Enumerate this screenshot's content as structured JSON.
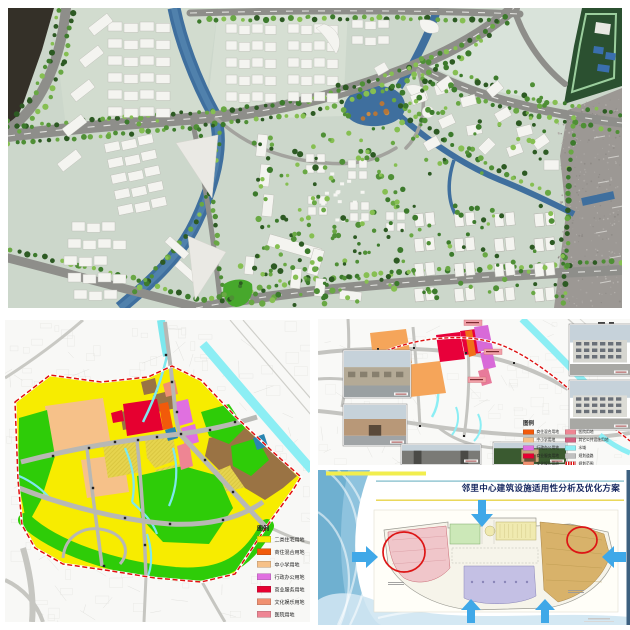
{
  "collage": {
    "background": "#ffffff",
    "panels": [
      "model-photo",
      "landuse-map",
      "facilities-map",
      "analysis-slide"
    ]
  },
  "model_photo": {
    "description": "aerial photo of physical urban-planning scale model",
    "colors": {
      "base_plate": "#ccd7cb",
      "river": "#3f6f9e",
      "road": "#8e8e8a",
      "building": "#f4f4f0",
      "tree_dark": "#2d5a23",
      "tree_light": "#86bf52",
      "gravel": "#9c9894",
      "side_model": "#2b5030"
    }
  },
  "left_map": {
    "legend_title": "图例",
    "legend_items": [
      {
        "label": "二类住宅用地",
        "color": "#f7ec00"
      },
      {
        "label": "商住混合用地",
        "color": "#f25a0a"
      },
      {
        "label": "中小学用地",
        "color": "#f6c189"
      },
      {
        "label": "行政办公用地",
        "color": "#e070e0"
      },
      {
        "label": "商业服务用地",
        "color": "#e60030"
      },
      {
        "label": "文化娱乐用地",
        "color": "#f09070"
      },
      {
        "label": "医院用地",
        "color": "#ee8593"
      },
      {
        "label": "其它公共设施",
        "color": "#d26080"
      }
    ],
    "colors": {
      "water": "#7de8ee",
      "road": "#b8b8b4",
      "boundary": "#e01010",
      "green_space": "#2ecc08",
      "village": "#9a7344"
    }
  },
  "right_map": {
    "legend_title": "图例",
    "legend_left": [
      {
        "label": "商住混合用地",
        "color": "#f25a0a"
      },
      {
        "label": "中小学用地",
        "color": "#f6c189"
      },
      {
        "label": "行政办公用地",
        "color": "#e070e0"
      },
      {
        "label": "商业服务用地",
        "color": "#e60030"
      },
      {
        "label": "文化娱乐用地",
        "color": "#f09070"
      }
    ],
    "legend_right": [
      {
        "label": "医院用地",
        "color": "#ee8593"
      },
      {
        "label": "其它公共设施用地",
        "color": "#d26080"
      },
      {
        "label": "水域",
        "color": "#8ceef4"
      },
      {
        "label": "规划道路",
        "color": "#c0c0c0"
      },
      {
        "label": "规划范围",
        "color": "#dd1111"
      }
    ]
  },
  "slide": {
    "title": "邻里中心建筑设施适用性分析及优化方案",
    "title_color": "#15265e",
    "highlight_color": "#dd1515",
    "arrow_color": "#3fa8e8",
    "plan_zones": [
      {
        "name": "west-wing",
        "color": "#f0c6ca"
      },
      {
        "name": "north-block-a",
        "color": "#cce8b8"
      },
      {
        "name": "north-block-b",
        "color": "#f0eab0"
      },
      {
        "name": "east-wing",
        "color": "#d8b26a"
      },
      {
        "name": "south-block",
        "color": "#c4c0e4"
      }
    ]
  }
}
